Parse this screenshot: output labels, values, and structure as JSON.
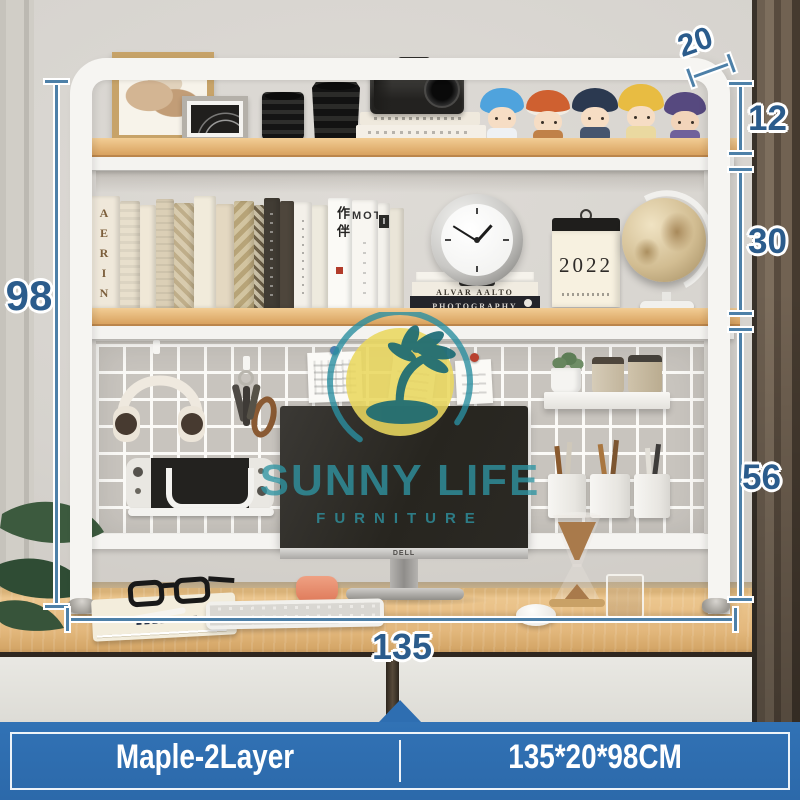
{
  "palette": {
    "banner_blue": "#2e6eb1",
    "annotation_line_blue": "#4d80a8",
    "annotation_number_blue": "#2b5c8c",
    "shelf_wood_maple": "#e2b377",
    "frame_white": "#f6f5f2",
    "watermark_teal": "#2f95a3",
    "watermark_yellow": "#e9d75e"
  },
  "annotations": {
    "depth": "20",
    "top_gap": "12",
    "shelf_gap": "30",
    "lower_gap": "56",
    "height": "98",
    "length": "135"
  },
  "banner": {
    "variant_label": "Maple-2Layer",
    "size_label": "135*20*98CM"
  },
  "watermark": {
    "brand": "SUNNY LIFE",
    "tagline": "FURNITURE"
  },
  "scene": {
    "monitor_brand": "DELL",
    "calendar_year": "2022",
    "books": {
      "spine_aerin": "AERIN",
      "spine_zuoban": "作伴",
      "spine_mot": "MOT",
      "spine_i": "I",
      "stack_mid": "ALVAR AALTO",
      "stack_bottom": "PHOTOGRAPHY"
    }
  }
}
